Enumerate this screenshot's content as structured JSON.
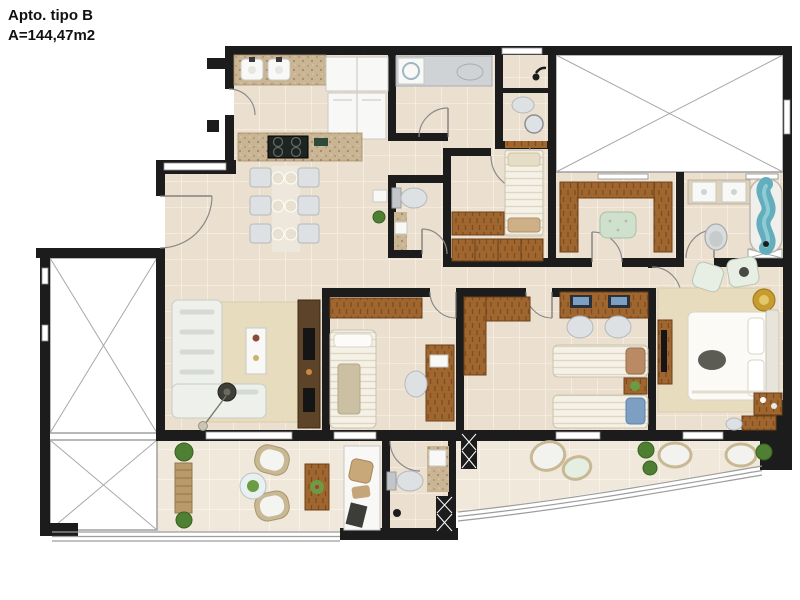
{
  "title": {
    "line1": "Apto. tipo B",
    "line2": "A=144,47m2"
  },
  "plan": {
    "type": "apartment-floor-plan",
    "colors": {
      "wall": "#1c1c1c",
      "floor": "#ebe0cf",
      "balcony_floor": "#f0e8da",
      "void_white": "#ffffff",
      "granite": "#c9b594",
      "wood": "#a0662f",
      "wood_dark": "#5d4327",
      "white_furniture": "#f8f8f6",
      "sofa": "#eef0ec",
      "rug": "#e8dcbf",
      "water_blue": "#62aebc",
      "plant_green": "#4e7f33",
      "gold": "#c79b2e",
      "tan": "#c9b89a",
      "accent_blue": "#7d9fc4",
      "ottoman_green": "#cfe0cc"
    }
  }
}
